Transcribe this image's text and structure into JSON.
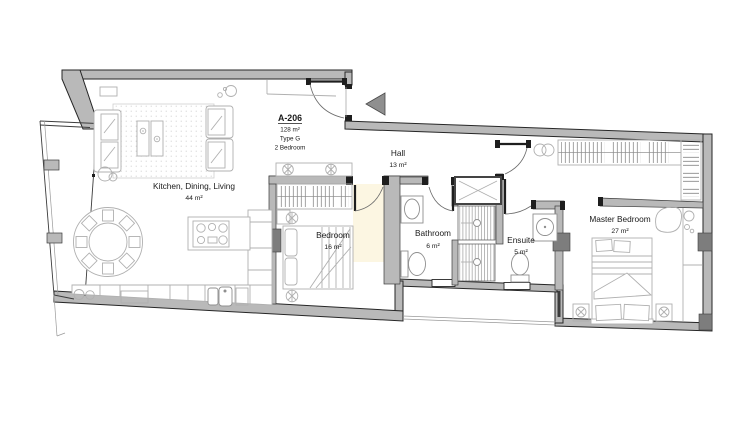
{
  "unit": {
    "id": "A-206",
    "area": "128 m²",
    "type": "Type G",
    "bedrooms": "2 Bedroom"
  },
  "rooms": [
    {
      "name": "Kitchen, Dining, Living",
      "area": "44 m²"
    },
    {
      "name": "Bedroom",
      "area": "16 m²"
    },
    {
      "name": "Hall",
      "area": "13 m²"
    },
    {
      "name": "Bathroom",
      "area": "6 m²"
    },
    {
      "name": "Ensuite",
      "area": "5 m²"
    },
    {
      "name": "Master Bedroom",
      "area": "27 m²"
    }
  ],
  "icons": {
    "entry_arrow": "triangle-left",
    "duct_shaft": "crossed-box",
    "ceiling_light": "double-circle"
  },
  "palette": {
    "bg": "#ffffff",
    "wall": "#b9b9b9",
    "edge": "#3c3c3c",
    "outline": "#262626",
    "cap": "#1e1e1e",
    "block": "#7d7d7d",
    "furniture": "#b0b0b0",
    "fixture": "#8f8f8f",
    "door": "#6b6b6b",
    "arrow": "#8f8f8f",
    "tint": "#fbf4dd",
    "text": "#1a1a1a"
  }
}
